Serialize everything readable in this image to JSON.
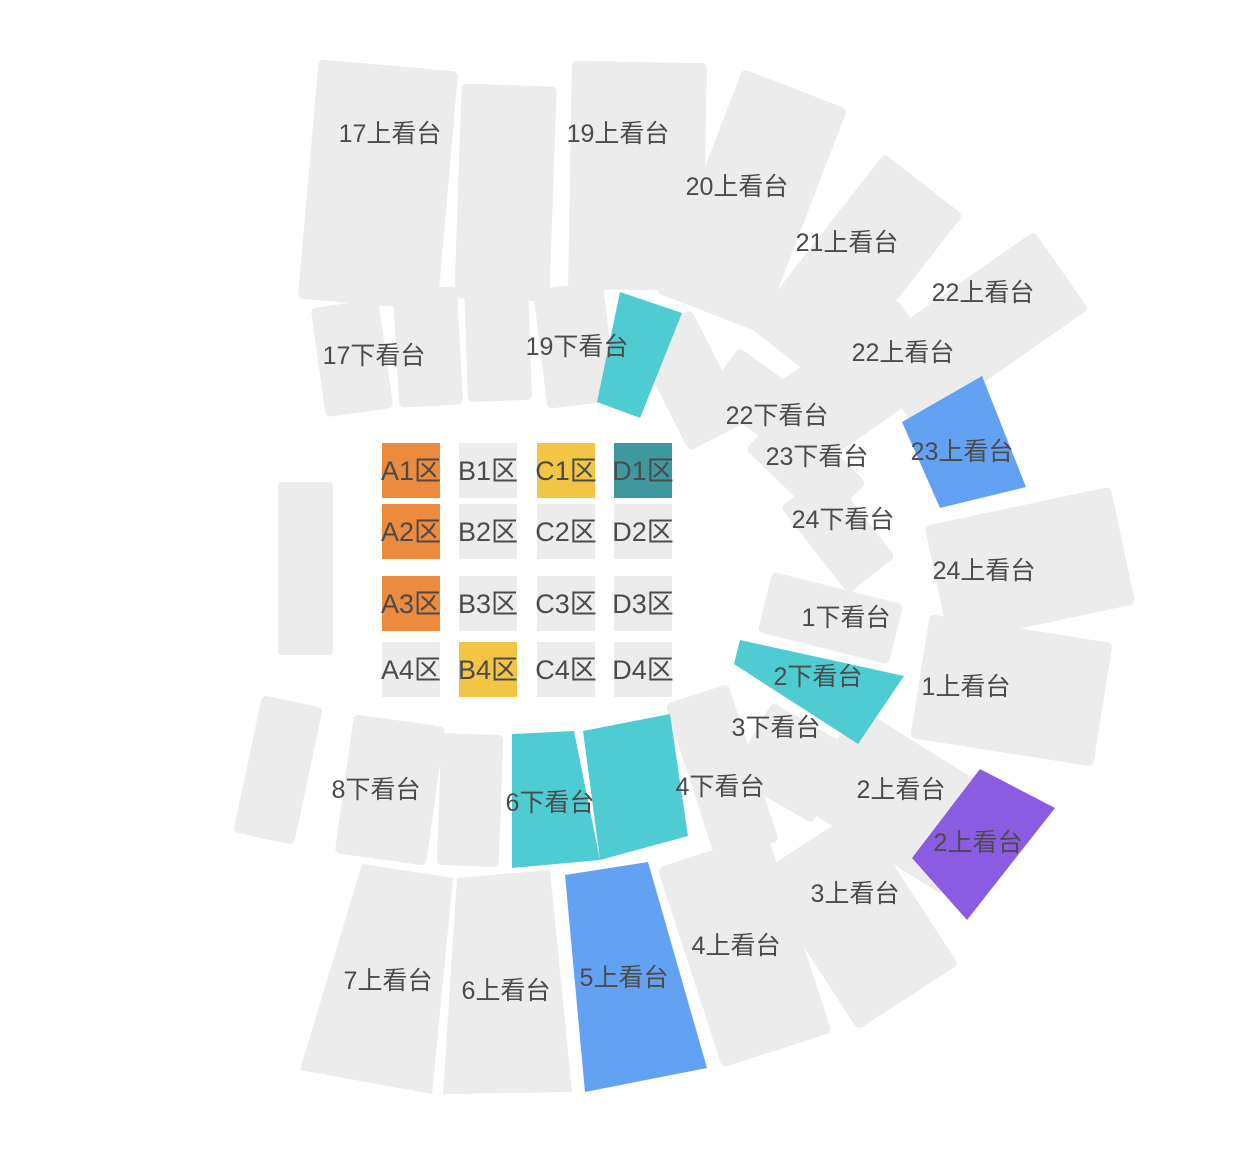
{
  "map_title": "arena-seat-map",
  "palette": {
    "unavailable_gray": "#ECECEC",
    "cyan_highlight": "#4FCBD2",
    "blue_highlight": "#63A2F2",
    "purple_highlight": "#8B5BE1",
    "orange_block": "#EC8A3D",
    "yellow_block": "#F2C644",
    "teal_block": "#40989F",
    "label_text": "#4b4b4b"
  },
  "stands": [
    {
      "label": "17上看台",
      "color": "#ECECEC"
    },
    {
      "label": "",
      "color": "#ECECEC"
    },
    {
      "label": "19上看台",
      "color": "#ECECEC"
    },
    {
      "label": "20上看台",
      "color": "#ECECEC"
    },
    {
      "label": "21上看台",
      "color": "#ECECEC"
    },
    {
      "label": "22上看台",
      "color": "#ECECEC"
    },
    {
      "label": "22上看台",
      "color": "#ECECEC"
    },
    {
      "label": "23上看台",
      "color": "#63A2F2"
    },
    {
      "label": "24上看台",
      "color": "#ECECEC"
    },
    {
      "label": "1上看台",
      "color": "#ECECEC"
    },
    {
      "label": "2上看台",
      "color": "#ECECEC"
    },
    {
      "label": "2上看台",
      "color": "#8B5BE1"
    },
    {
      "label": "3上看台",
      "color": "#ECECEC"
    },
    {
      "label": "4上看台",
      "color": "#ECECEC"
    },
    {
      "label": "5上看台",
      "color": "#63A2F2"
    },
    {
      "label": "6上看台",
      "color": "#ECECEC"
    },
    {
      "label": "7上看台",
      "color": "#ECECEC"
    },
    {
      "label": "",
      "color": "#ECECEC"
    },
    {
      "label": "8下看台",
      "color": "#ECECEC"
    },
    {
      "label": "",
      "color": "#ECECEC"
    },
    {
      "label": "6下看台",
      "color": "#4FCBD2"
    },
    {
      "label": "",
      "color": "#4FCBD2"
    },
    {
      "label": "4下看台",
      "color": "#ECECEC"
    },
    {
      "label": "3下看台",
      "color": "#ECECEC"
    },
    {
      "label": "2下看台",
      "color": "#4FCBD2"
    },
    {
      "label": "1下看台",
      "color": "#ECECEC"
    },
    {
      "label": "24下看台",
      "color": "#ECECEC"
    },
    {
      "label": "23下看台",
      "color": "#ECECEC"
    },
    {
      "label": "22下看台",
      "color": "#ECECEC"
    },
    {
      "label": "17下看台",
      "color": "#ECECEC"
    },
    {
      "label": "",
      "color": "#ECECEC"
    },
    {
      "label": "",
      "color": "#ECECEC"
    },
    {
      "label": "19下看台",
      "color": "#ECECEC"
    },
    {
      "label": "",
      "color": "#4FCBD2"
    },
    {
      "label": "",
      "color": "#ECECEC"
    },
    {
      "label": "",
      "color": "#ECECEC"
    }
  ],
  "blocks": [
    {
      "label": "A1区",
      "color": "#EC8A3D"
    },
    {
      "label": "B1区",
      "color": "#ECECEC"
    },
    {
      "label": "C1区",
      "color": "#F2C644"
    },
    {
      "label": "D1区",
      "color": "#40989F"
    },
    {
      "label": "A2区",
      "color": "#EC8A3D"
    },
    {
      "label": "B2区",
      "color": "#ECECEC"
    },
    {
      "label": "C2区",
      "color": "#ECECEC"
    },
    {
      "label": "D2区",
      "color": "#ECECEC"
    },
    {
      "label": "A3区",
      "color": "#EC8A3D"
    },
    {
      "label": "B3区",
      "color": "#ECECEC"
    },
    {
      "label": "C3区",
      "color": "#ECECEC"
    },
    {
      "label": "D3区",
      "color": "#ECECEC"
    },
    {
      "label": "A4区",
      "color": "#ECECEC"
    },
    {
      "label": "B4区",
      "color": "#F2C644"
    },
    {
      "label": "C4区",
      "color": "#ECECEC"
    },
    {
      "label": "D4区",
      "color": "#ECECEC"
    }
  ]
}
